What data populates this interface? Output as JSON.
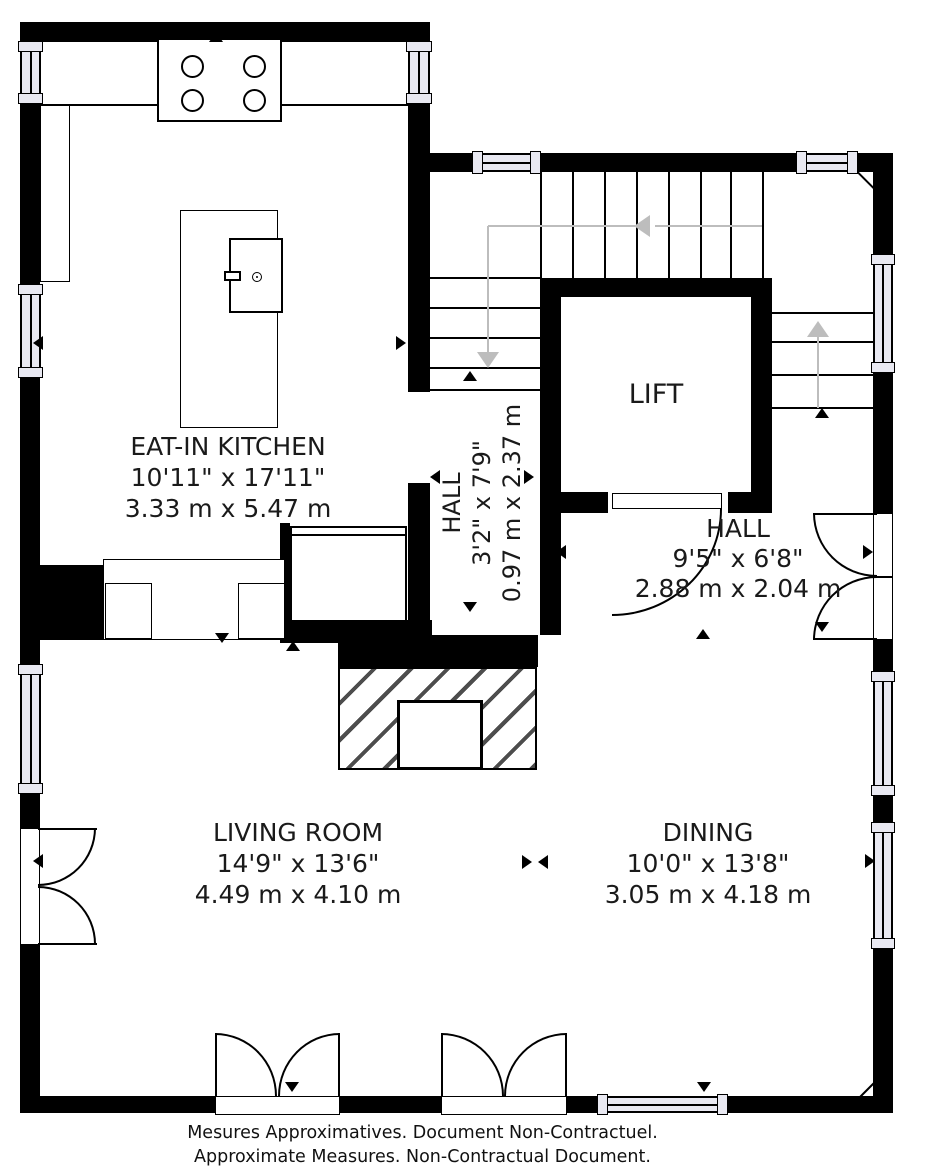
{
  "rooms": {
    "kitchen": {
      "name": "EAT-IN KITCHEN",
      "imperial": "10'11\" x 17'11\"",
      "metric": "3.33 m x 5.47 m"
    },
    "hall_upper": {
      "name": "HALL",
      "imperial": "3'2\" x 7'9\"",
      "metric": "0.97 m x 2.37 m"
    },
    "hall_entry": {
      "name": "HALL",
      "imperial": "9'5\" x 6'8\"",
      "metric": "2.88 m x 2.04 m"
    },
    "lift": {
      "name": "LIFT"
    },
    "living_room": {
      "name": "LIVING ROOM",
      "imperial": "14'9\" x 13'6\"",
      "metric": "4.49 m x 4.10 m"
    },
    "dining": {
      "name": "DINING",
      "imperial": "10'0\" x 13'8\"",
      "metric": "3.05 m x 4.18 m"
    }
  },
  "footer": {
    "line1": "Mesures Approximatives. Document Non-Contractuel.",
    "line2": "Approximate Measures. Non-Contractual Document."
  },
  "colors": {
    "wall": "#000000",
    "window_fill": "#e9e9f2",
    "stair_guide": "#bdbdbd",
    "background": "#ffffff"
  }
}
